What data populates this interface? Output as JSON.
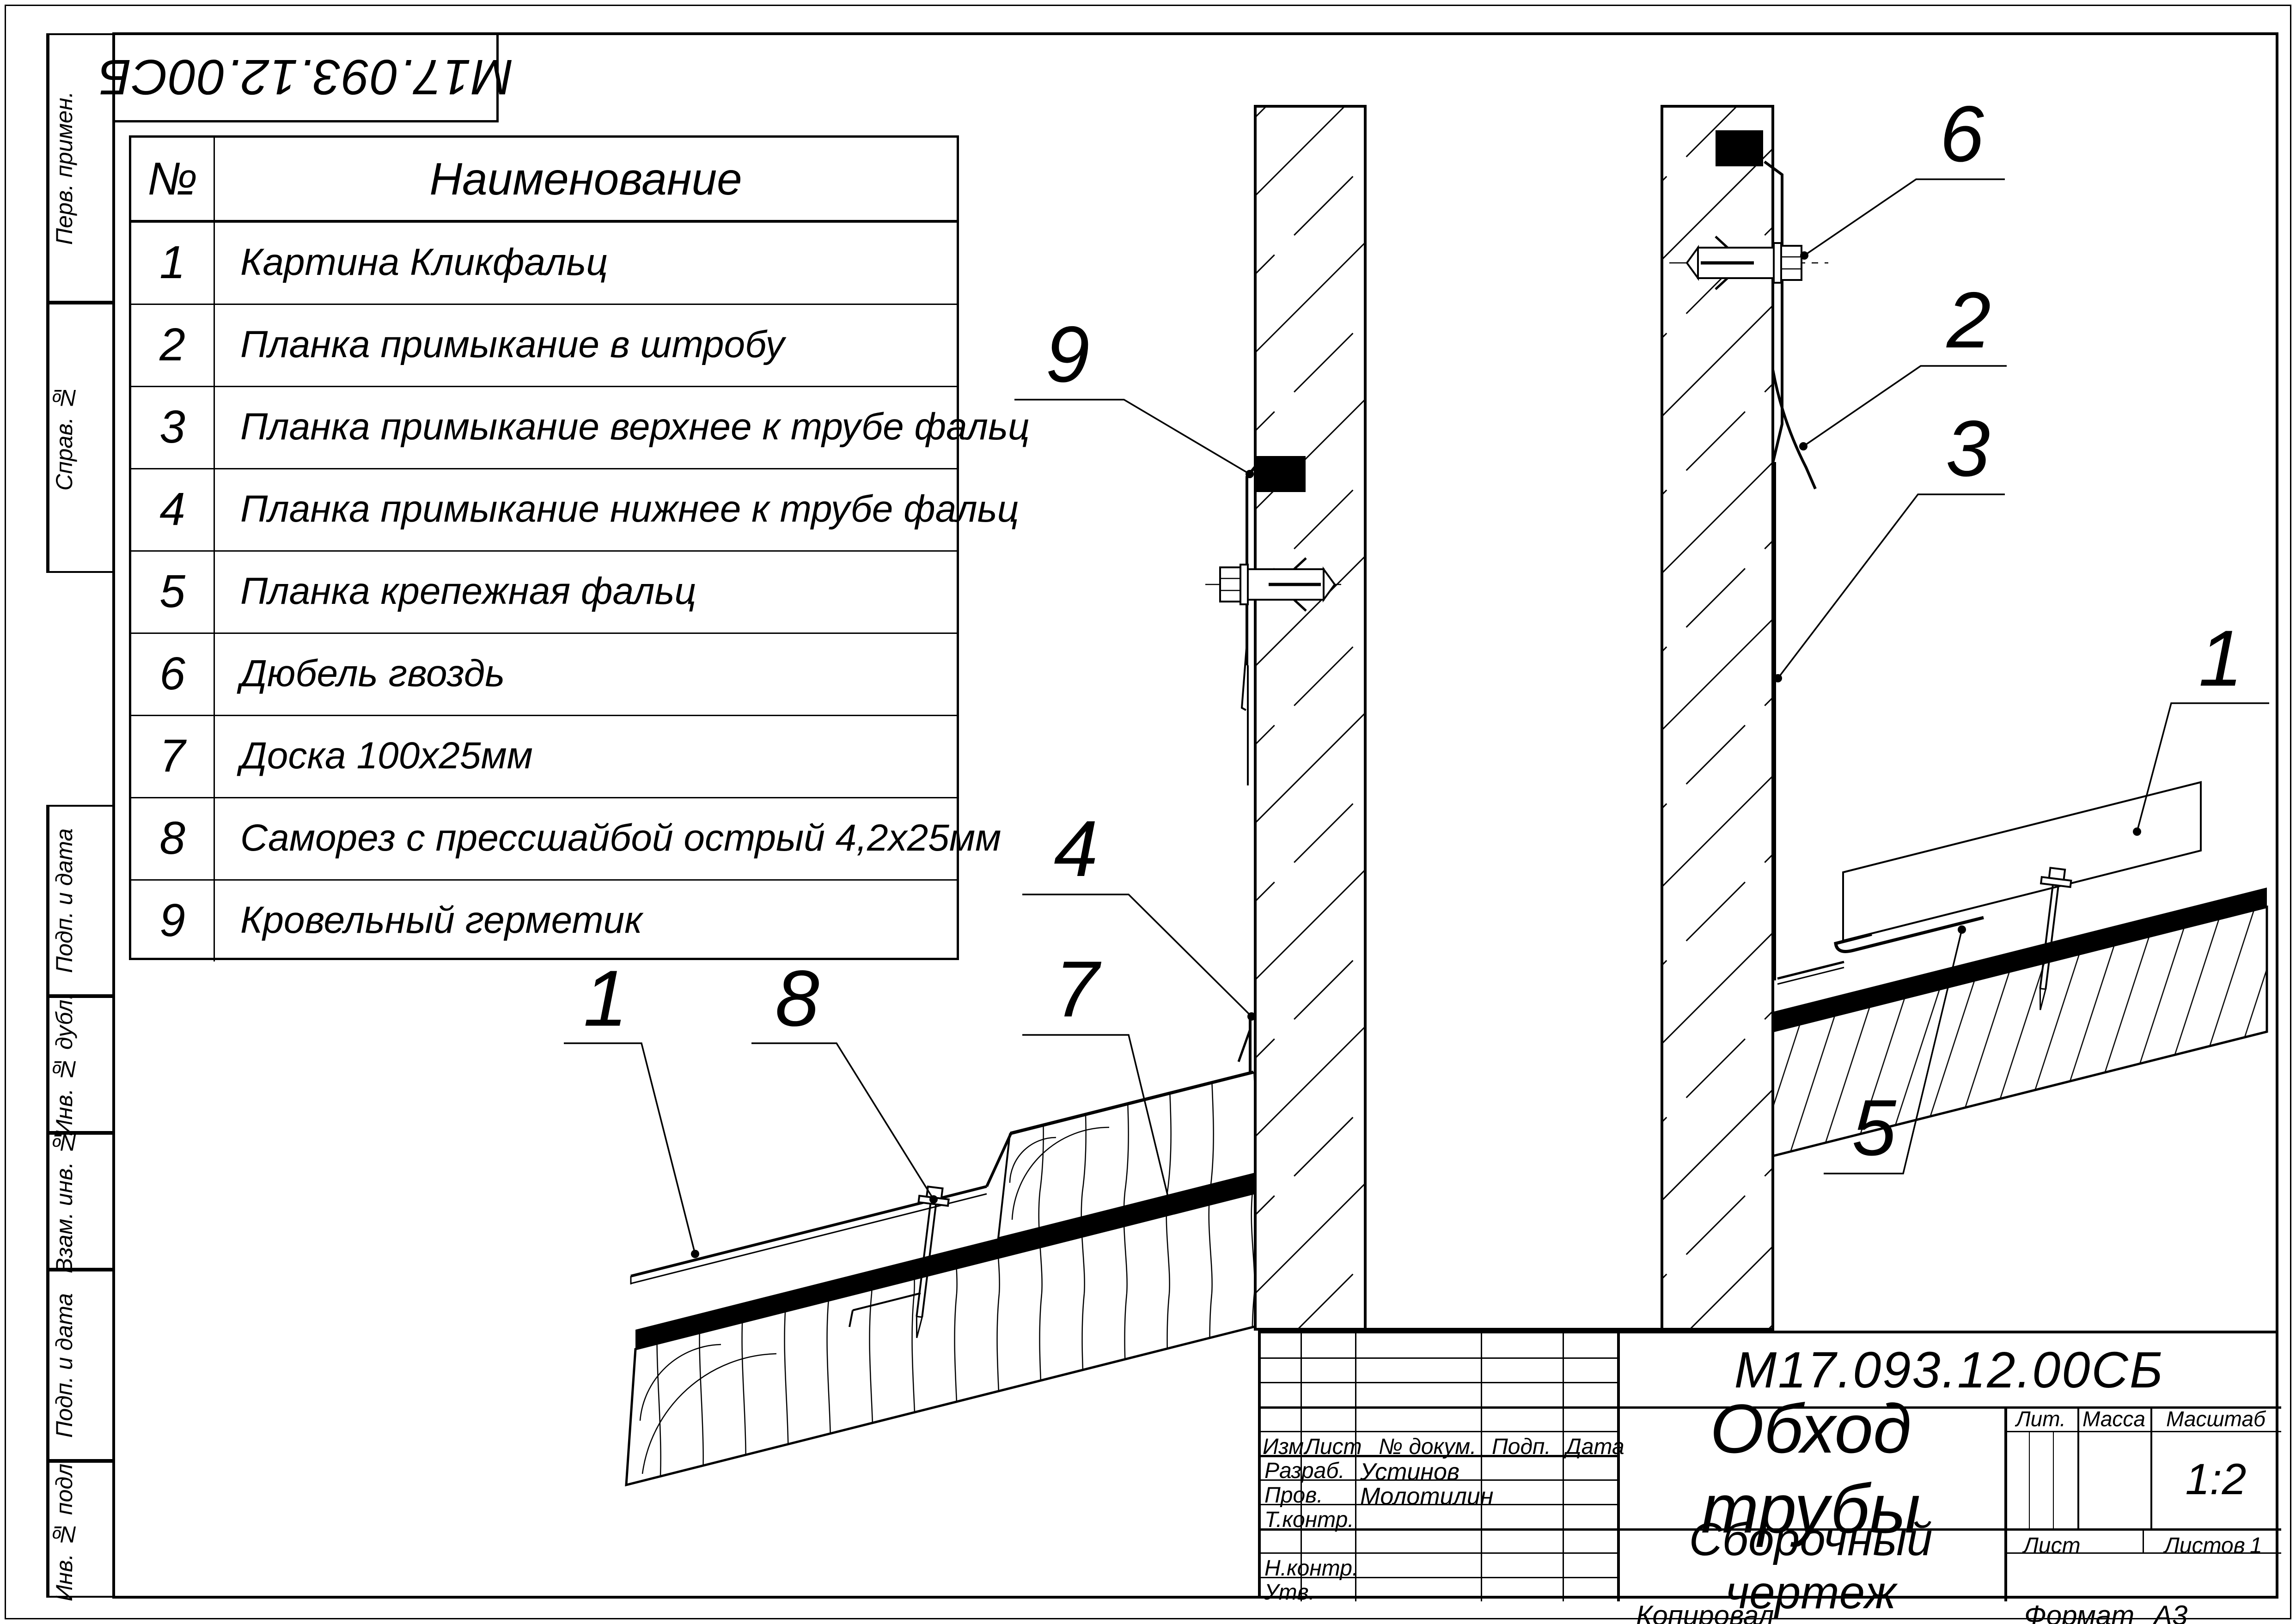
{
  "sheet": {
    "reversed_designation": "М17.093.12.00СБ",
    "margin_labels": [
      "Перв. примен.",
      "Справ. №",
      "Подп. и дата",
      "Инв. № дубл.",
      "Взам. инв. №",
      "Подп. и дата",
      "Инв. № подл."
    ],
    "footer": {
      "copied": "Копировал",
      "format_label": "Формат",
      "format_value": "А3"
    }
  },
  "parts": {
    "headers": {
      "num": "№",
      "name": "Наименование"
    },
    "rows": [
      {
        "num": "1",
        "name": "Картина Кликфальц"
      },
      {
        "num": "2",
        "name": "Планка примыкание в штробу"
      },
      {
        "num": "3",
        "name": "Планка примыкание верхнее к трубе фальц"
      },
      {
        "num": "4",
        "name": "Планка примыкание нижнее к трубе фальц"
      },
      {
        "num": "5",
        "name": "Планка крепежная фальц"
      },
      {
        "num": "6",
        "name": "Дюбель гвоздь"
      },
      {
        "num": "7",
        "name": "Доска 100х25мм"
      },
      {
        "num": "8",
        "name": "Саморез с прессшайбой острый 4,2х25мм"
      },
      {
        "num": "9",
        "name": "Кровельный герметик"
      }
    ]
  },
  "callouts": [
    {
      "n": "9"
    },
    {
      "n": "6"
    },
    {
      "n": "2"
    },
    {
      "n": "3"
    },
    {
      "n": "1"
    },
    {
      "n": "4"
    },
    {
      "n": "7"
    },
    {
      "n": "1"
    },
    {
      "n": "8"
    },
    {
      "n": "5"
    }
  ],
  "title_block": {
    "designation": "М17.093.12.00СБ",
    "title": "Обход трубы",
    "doc_type": "Сборочный чертеж",
    "labels": {
      "izm": "Изм.",
      "list": "Лист",
      "doc": "№ докум.",
      "podp": "Подп.",
      "data": "Дата",
      "razrab": "Разраб.",
      "prov": "Пров.",
      "tkontr": "Т.контр.",
      "nkontr": "Н.контр.",
      "utv": "Утв.",
      "lit": "Лит.",
      "massa": "Масса",
      "masshtab": "Масштаб",
      "list2": "Лист",
      "listov": "Листов"
    },
    "values": {
      "razrab_name": "Устинов",
      "prov_name": "Молотилин",
      "scale": "1:2",
      "listov_value": "1"
    }
  }
}
